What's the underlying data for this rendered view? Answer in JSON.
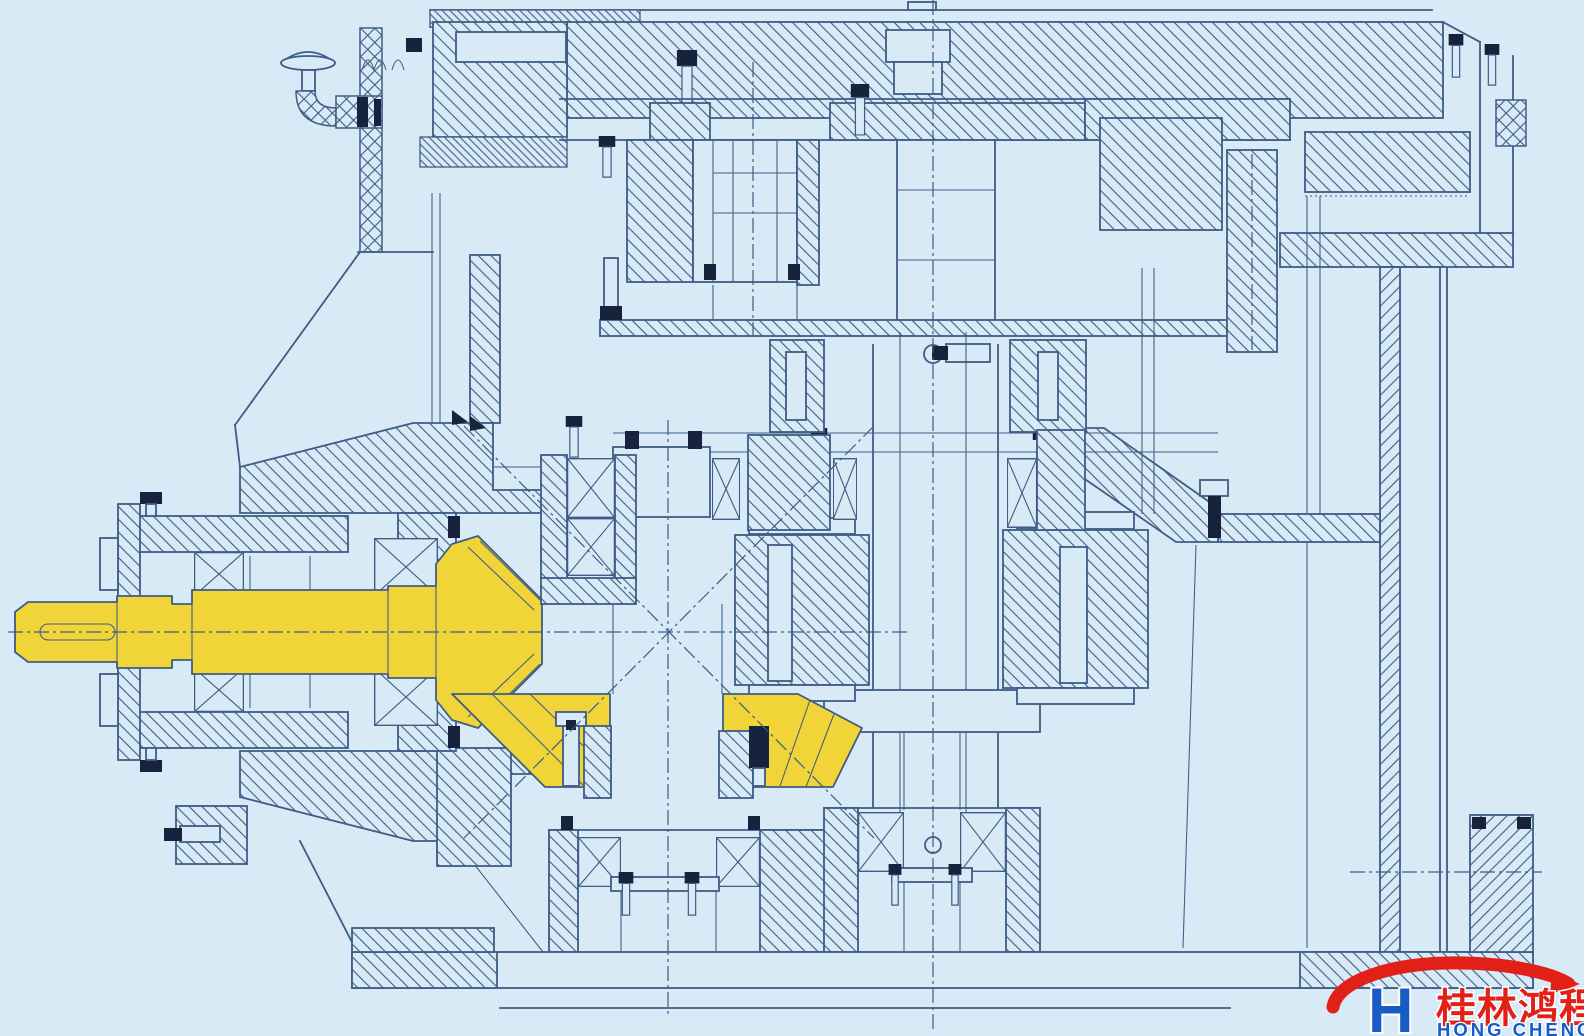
{
  "canvas": {
    "width": 1584,
    "height": 1036
  },
  "colors": {
    "background": "#d7eaf5",
    "line": "#3e5c86",
    "dark": "#17233d",
    "highlight": "#f1d437",
    "logo_red": "#e32017",
    "logo_blue": "#175bc4",
    "white": "#eef7fc"
  },
  "logo": {
    "monogram": "H",
    "chinese": "桂林鸿程",
    "english": "HONG CHENG"
  }
}
